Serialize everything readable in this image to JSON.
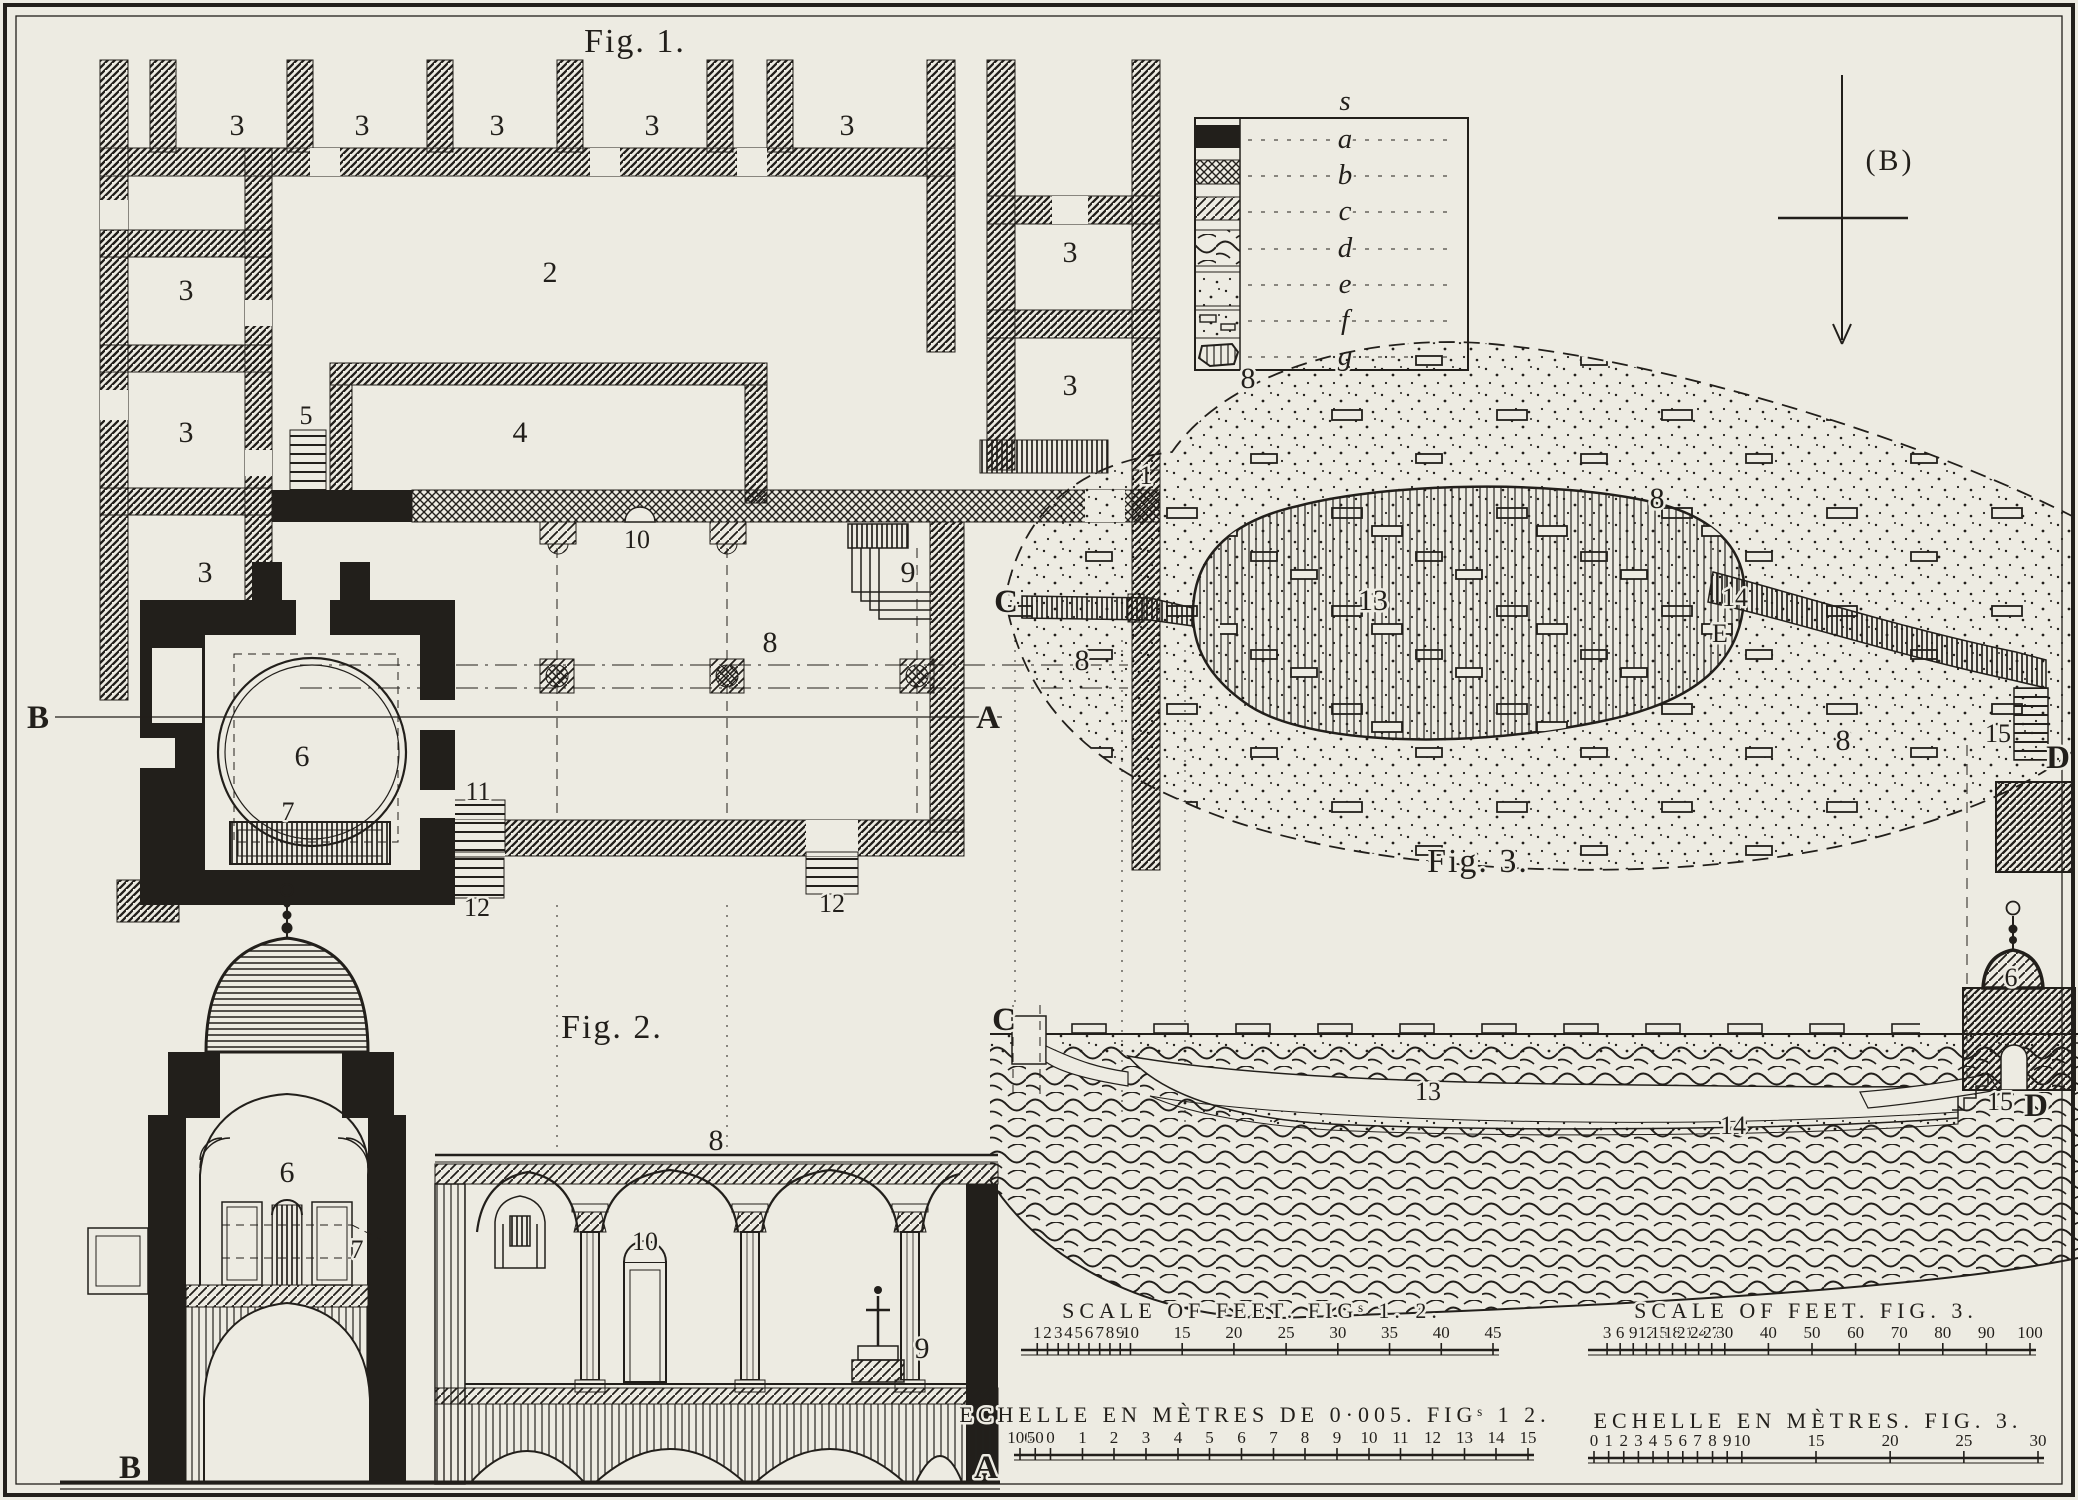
{
  "plate": {
    "fig1": {
      "title": "Fig. 1."
    },
    "fig2": {
      "title": "Fig. 2."
    },
    "fig3": {
      "title": "Fig. 3."
    },
    "labels": {
      "n1": "1",
      "n2": "2",
      "n3": "3",
      "n4": "4",
      "n5": "5",
      "n6": "6",
      "n7": "7",
      "n8": "8",
      "n9": "9",
      "n10": "10",
      "n11": "11",
      "n12": "12",
      "n13": "13",
      "n14": "14",
      "n15": "15"
    },
    "markers": {
      "A": "A",
      "B": "B",
      "C": "C",
      "D": "D",
      "E": "E"
    },
    "compass": {
      "label": "(B)"
    },
    "legend": {
      "header": "s",
      "entries": [
        {
          "letter": "a",
          "swatch": "solid-black"
        },
        {
          "letter": "b",
          "swatch": "cross-hatch"
        },
        {
          "letter": "c",
          "swatch": "diagonal-hatch"
        },
        {
          "letter": "d",
          "swatch": "rubble-hatch"
        },
        {
          "letter": "e",
          "swatch": "stipple"
        },
        {
          "letter": "f",
          "swatch": "stones-in-earth"
        },
        {
          "letter": "g",
          "swatch": "cut-stone"
        }
      ]
    },
    "scales": {
      "feet12": {
        "title": "SCALE OF FEET. FIGˢ 1. 2.",
        "ticks": [
          {
            "l": "1",
            "p": 0.022
          },
          {
            "l": "2",
            "p": 0.044
          },
          {
            "l": "3",
            "p": 0.067
          },
          {
            "l": "4",
            "p": 0.089
          },
          {
            "l": "5",
            "p": 0.111
          },
          {
            "l": "6",
            "p": 0.133
          },
          {
            "l": "7",
            "p": 0.156
          },
          {
            "l": "8",
            "p": 0.178
          },
          {
            "l": "9",
            "p": 0.2
          },
          {
            "l": "10",
            "p": 0.222
          },
          {
            "l": "15",
            "p": 0.333
          },
          {
            "l": "20",
            "p": 0.444
          },
          {
            "l": "25",
            "p": 0.556
          },
          {
            "l": "30",
            "p": 0.667
          },
          {
            "l": "35",
            "p": 0.778
          },
          {
            "l": "40",
            "p": 0.889
          },
          {
            "l": "45",
            "p": 1
          }
        ]
      },
      "metres12": {
        "title": "ECHELLE EN MÈTRES DE 0·005. FIGˢ 1 2.",
        "ticks": [
          {
            "l": "100",
            "p": 0
          },
          {
            "l": "50",
            "p": 0.03
          },
          {
            "l": "0",
            "p": 0.06
          },
          {
            "l": "1",
            "p": 0.123
          },
          {
            "l": "2",
            "p": 0.185
          },
          {
            "l": "3",
            "p": 0.248
          },
          {
            "l": "4",
            "p": 0.311
          },
          {
            "l": "5",
            "p": 0.373
          },
          {
            "l": "6",
            "p": 0.436
          },
          {
            "l": "7",
            "p": 0.499
          },
          {
            "l": "8",
            "p": 0.561
          },
          {
            "l": "9",
            "p": 0.624
          },
          {
            "l": "10",
            "p": 0.687
          },
          {
            "l": "11",
            "p": 0.749
          },
          {
            "l": "12",
            "p": 0.812
          },
          {
            "l": "13",
            "p": 0.875
          },
          {
            "l": "14",
            "p": 0.937
          },
          {
            "l": "15",
            "p": 1
          }
        ]
      },
      "feet3": {
        "title": "SCALE OF FEET. FIG. 3.",
        "ticks": [
          {
            "l": "3",
            "p": 0.03
          },
          {
            "l": "6",
            "p": 0.06
          },
          {
            "l": "9",
            "p": 0.09
          },
          {
            "l": "12",
            "p": 0.12
          },
          {
            "l": "15",
            "p": 0.15
          },
          {
            "l": "18",
            "p": 0.18
          },
          {
            "l": "21",
            "p": 0.21
          },
          {
            "l": "24",
            "p": 0.24
          },
          {
            "l": "27",
            "p": 0.27
          },
          {
            "l": "30",
            "p": 0.3
          },
          {
            "l": "40",
            "p": 0.4
          },
          {
            "l": "50",
            "p": 0.5
          },
          {
            "l": "60",
            "p": 0.6
          },
          {
            "l": "70",
            "p": 0.7
          },
          {
            "l": "80",
            "p": 0.8
          },
          {
            "l": "90",
            "p": 0.9
          },
          {
            "l": "100",
            "p": 1
          }
        ]
      },
      "metres3": {
        "title": "ECHELLE EN MÈTRES. FIG. 3.",
        "ticks": [
          {
            "l": "0",
            "p": 0
          },
          {
            "l": "1",
            "p": 0.033
          },
          {
            "l": "2",
            "p": 0.067
          },
          {
            "l": "3",
            "p": 0.1
          },
          {
            "l": "4",
            "p": 0.133
          },
          {
            "l": "5",
            "p": 0.167
          },
          {
            "l": "6",
            "p": 0.2
          },
          {
            "l": "7",
            "p": 0.233
          },
          {
            "l": "8",
            "p": 0.267
          },
          {
            "l": "9",
            "p": 0.3
          },
          {
            "l": "10",
            "p": 0.333
          },
          {
            "l": "15",
            "p": 0.5
          },
          {
            "l": "20",
            "p": 0.667
          },
          {
            "l": "25",
            "p": 0.833
          },
          {
            "l": "30",
            "p": 1
          }
        ]
      }
    }
  }
}
